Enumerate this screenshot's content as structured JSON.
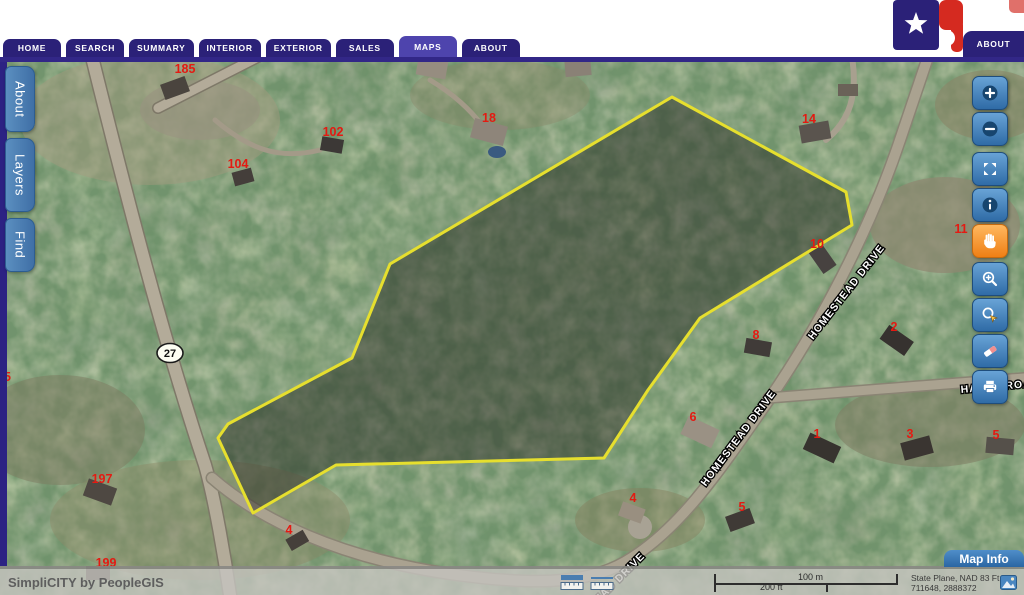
{
  "header": {
    "nav_tabs": [
      {
        "label": "HOME",
        "active": false
      },
      {
        "label": "SEARCH",
        "active": false
      },
      {
        "label": "SUMMARY",
        "active": false
      },
      {
        "label": "INTERIOR",
        "active": false
      },
      {
        "label": "EXTERIOR",
        "active": false
      },
      {
        "label": "SALES",
        "active": false
      },
      {
        "label": "MAPS",
        "active": true
      },
      {
        "label": "ABOUT",
        "active": false
      }
    ],
    "corner_tab_label": "ABOUT",
    "brand_colors": {
      "tab_inactive": "#2b2178",
      "tab_active": "#4e44ad",
      "strip": "#322787",
      "logo_red": "#d52a20",
      "logo_blue": "#2b2178"
    }
  },
  "side_panel_tabs": [
    {
      "label": "About"
    },
    {
      "label": "Layers"
    },
    {
      "label": "Find"
    }
  ],
  "toolbar": {
    "active_tool": "pan",
    "buttons": [
      {
        "name": "zoom-in",
        "icon": "plus-circle"
      },
      {
        "name": "zoom-out",
        "icon": "minus-circle"
      },
      {
        "name": "full-extent",
        "icon": "full-extent"
      },
      {
        "name": "identify",
        "icon": "info"
      },
      {
        "name": "pan",
        "icon": "hand",
        "active": true
      },
      {
        "name": "zoom-window",
        "icon": "zoom-window"
      },
      {
        "name": "zoom-selection",
        "icon": "zoom-select"
      },
      {
        "name": "erase",
        "icon": "erase"
      },
      {
        "name": "print",
        "icon": "print"
      }
    ]
  },
  "map": {
    "parcel_outline_color": "#e6df2e",
    "parcel_fill": "rgba(35,35,32,0.45)",
    "selected_parcel_points": "672,97 846,192 852,225 700,318 648,390 604,458 336,465 253,513 218,438 228,424 352,358 390,264",
    "route_shield": {
      "text": "27",
      "x": 170,
      "y": 353
    },
    "parcel_number_color": "#e41a12",
    "parcel_numbers": [
      {
        "text": "185",
        "x": 185,
        "y": 73
      },
      {
        "text": "102",
        "x": 333,
        "y": 136
      },
      {
        "text": "104",
        "x": 238,
        "y": 168
      },
      {
        "text": "18",
        "x": 489,
        "y": 122
      },
      {
        "text": "14",
        "x": 809,
        "y": 123
      },
      {
        "text": "10",
        "x": 817,
        "y": 248
      },
      {
        "text": "11",
        "x": 961,
        "y": 233
      },
      {
        "text": "8",
        "x": 756,
        "y": 339
      },
      {
        "text": "2",
        "x": 894,
        "y": 331
      },
      {
        "text": "95",
        "x": 4,
        "y": 381
      },
      {
        "text": "197",
        "x": 102,
        "y": 483
      },
      {
        "text": "199",
        "x": 106,
        "y": 567
      },
      {
        "text": "4",
        "x": 289,
        "y": 534
      },
      {
        "text": "6",
        "x": 693,
        "y": 421
      },
      {
        "text": "4",
        "x": 633,
        "y": 502
      },
      {
        "text": "5",
        "x": 742,
        "y": 511
      },
      {
        "text": "1",
        "x": 817,
        "y": 438
      },
      {
        "text": "3",
        "x": 910,
        "y": 438
      },
      {
        "text": "5",
        "x": 996,
        "y": 439
      }
    ],
    "street_labels": [
      {
        "text": "HOMESTEAD DRIVE",
        "x": 849,
        "y": 294,
        "rotate": -52,
        "anchor": "middle"
      },
      {
        "text": "HOMESTEAD DRIVE",
        "x": 741,
        "y": 440,
        "rotate": -53,
        "anchor": "middle"
      },
      {
        "text": "EAD DRIVE",
        "x": 622,
        "y": 580,
        "rotate": -45,
        "anchor": "middle"
      },
      {
        "text": "HAVEN ROAD",
        "x": 961,
        "y": 393,
        "rotate": -5,
        "anchor": "start"
      }
    ]
  },
  "footer": {
    "branding": "SimpliCITY by PeopleGIS",
    "scale_bar": {
      "metric_label": "100 m",
      "imperial_label": "200 ft"
    },
    "projection_line1": "State Plane, NAD 83 Ft",
    "coordinates": "711648, 2888372"
  },
  "map_info": {
    "label": "Map Info"
  }
}
